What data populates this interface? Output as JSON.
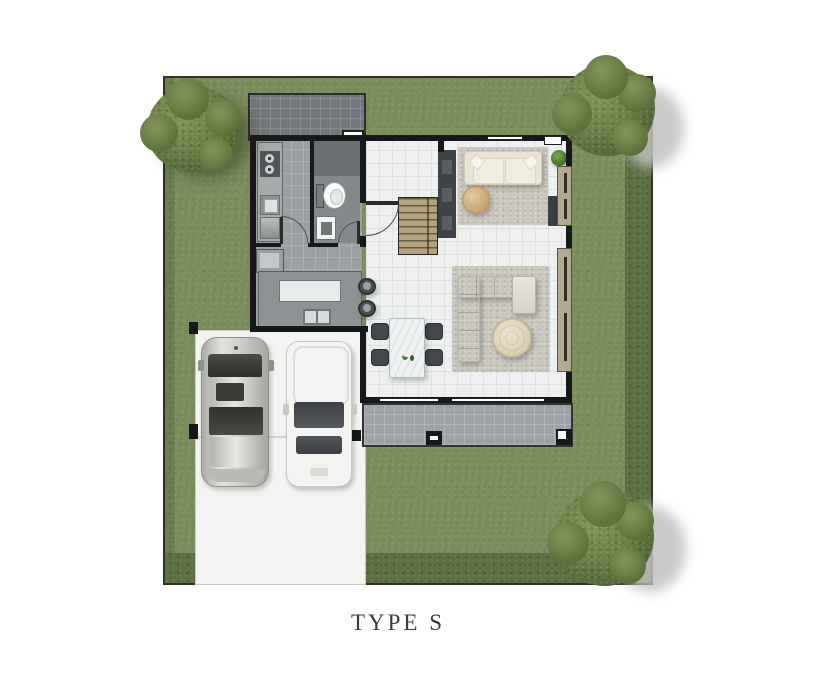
{
  "caption": "TYPE S",
  "diagram": {
    "kind": "house-floor-plan-top-view",
    "site": {
      "lawn": "grass yard surrounding house",
      "hedge_edges": [
        "bottom",
        "right"
      ],
      "trees": [
        "tree-top-left",
        "tree-top-right",
        "tree-bottom-right"
      ]
    },
    "house": {
      "rooms": [
        "service-terrace",
        "kitchen",
        "bathroom",
        "entry-hall",
        "staircase",
        "sitting-area",
        "living-area",
        "dining-area",
        "rear-terrace"
      ],
      "furniture": [
        "cream-sofa",
        "round-ottoman",
        "tv-console",
        "l-shaped-sectional-sofa",
        "round-coffee-table",
        "dining-table-for-four",
        "dining-chairs",
        "bar-stools",
        "kitchen-counter-run",
        "island-counter",
        "stove",
        "kitchen-sink",
        "toilet",
        "bathroom-sink",
        "wardrobe-cabinet"
      ],
      "openings": [
        "front-door-swing",
        "kitchen-door-swing",
        "bathroom-door-swing",
        "sliding-glass-doors",
        "right-wall-windows",
        "top-wall-window",
        "vent-box"
      ]
    },
    "carport": {
      "surface": "concrete-driveway",
      "vehicles": [
        "silver-sedan",
        "white-car"
      ],
      "posts": 3
    }
  },
  "colors": {
    "lawn": "#7E8F5E",
    "hedge": "#5C7041",
    "tree": "#5E7340",
    "wall": "#17181A",
    "interior_floor": "#EEF0EF",
    "kitchen_floor": "#9AA0A2",
    "bath_floor": "#84898B",
    "service_tile": "#73777A",
    "terrace_tile": "#9CA2A6",
    "stairs_wood": "#B2A37D",
    "driveway": "#F3F3F1",
    "rug": "#C7C5BC",
    "sofa_cream": "#E9E4D3",
    "sectional": "#DEDCD5",
    "travertine_table": "#E3D8C0",
    "dining_chair": "#42474B",
    "car_silver": "#C9CBC5",
    "car_white": "#F4F5F3",
    "caption_text": "#3B3B42"
  }
}
